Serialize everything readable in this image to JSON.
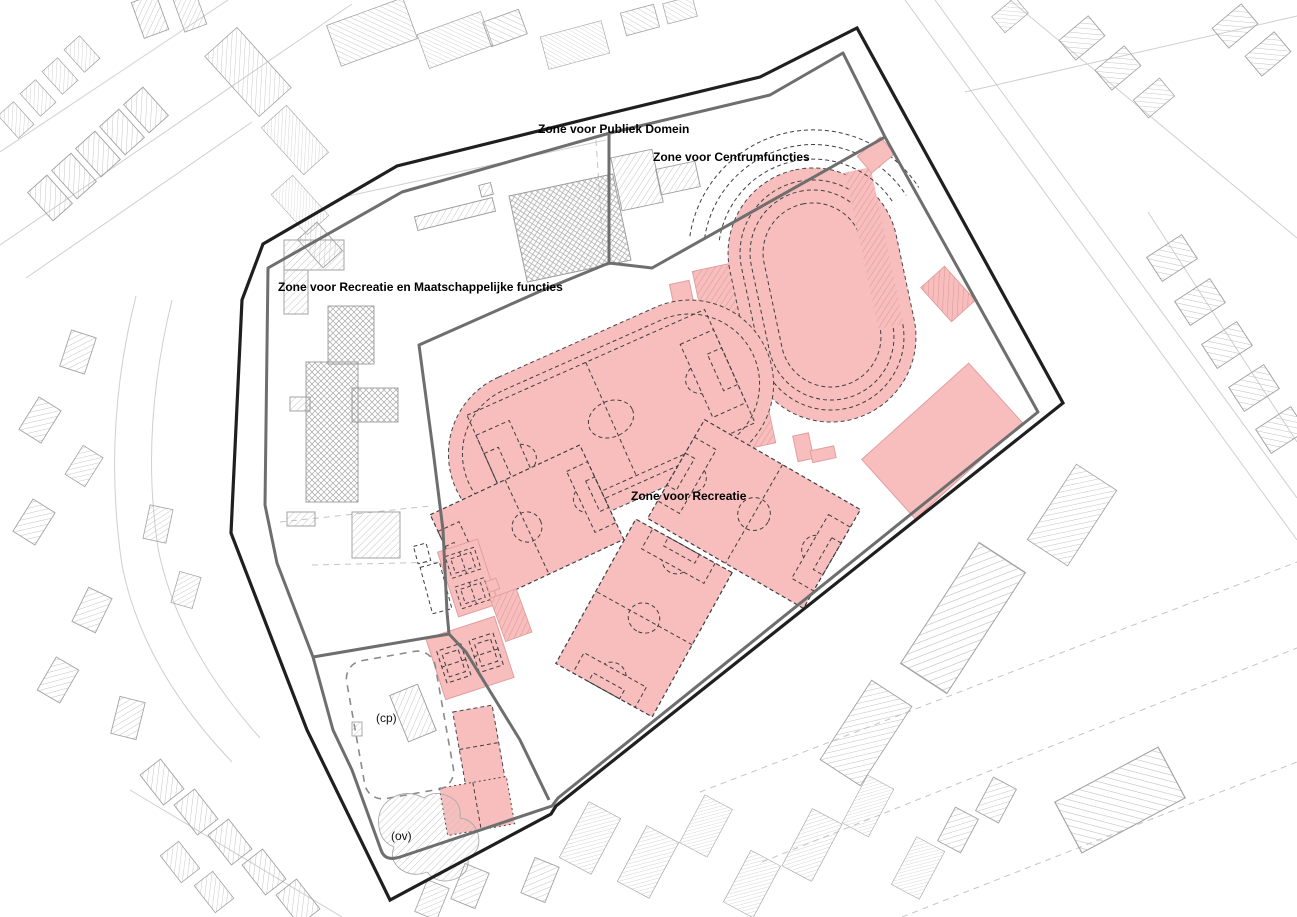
{
  "zones": [
    {
      "id": "publiek-domein",
      "label": "Zone voor Publiek Domein"
    },
    {
      "id": "centrumfuncties",
      "label": "Zone voor Centrumfuncties"
    },
    {
      "id": "recreatie-maatschappelijke",
      "label": "Zone voor Recreatie en Maatschappelijke functies"
    },
    {
      "id": "recreatie",
      "label": "Zone voor Recreatie"
    }
  ],
  "annotations": [
    {
      "id": "cp",
      "label": "(cp)"
    },
    {
      "id": "ov",
      "label": "(ov)"
    }
  ],
  "colors": {
    "sport_area_pink": "#f8bebe",
    "plan_boundary": "#1f1f1f",
    "zone_boundary_gray": "#6e6e6e",
    "building_hatch": "#b8b8b8",
    "parcel_line": "#cfcfcf"
  }
}
